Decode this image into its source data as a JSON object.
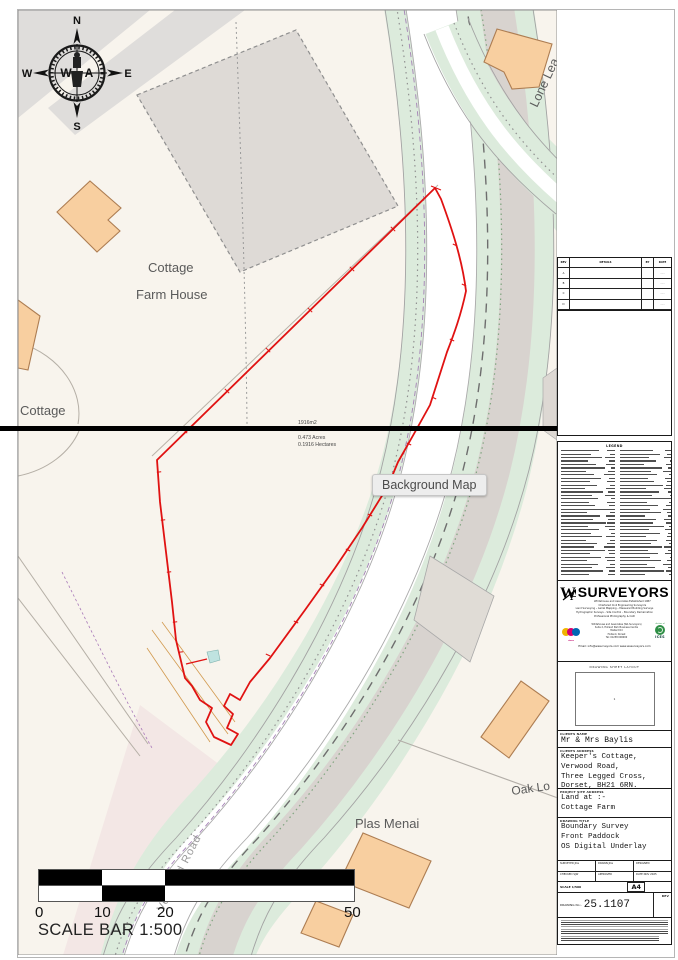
{
  "map": {
    "tooltip": "Background Map",
    "labels": {
      "cottage_top": "Cottage",
      "farm_house": "Farm House",
      "cottage_left": "Cottage",
      "lone_lea": "Lone Lea",
      "plas_menai": "Plas Menai",
      "oak_lodge": "Oak Lo",
      "verwood_road": "Verwood Road"
    },
    "area": {
      "sqm": "1916m2",
      "acres": "0.473 Acres",
      "hectares": "0.1916 Hectares"
    },
    "compass": {
      "n": "N",
      "s": "S",
      "e": "E",
      "w": "W",
      "inner_w": "W",
      "inner_a": "A"
    },
    "scale_bar": {
      "ticks": [
        "0",
        "10",
        "20",
        "50"
      ],
      "caption": "SCALE BAR 1:500"
    }
  },
  "panel": {
    "revisions": {
      "headers": [
        "REV",
        "DETAILS",
        "BY",
        "DATE"
      ],
      "rows": [
        [
          "A",
          "",
          "",
          "··.··"
        ],
        [
          "B",
          "",
          "",
          "··.··"
        ],
        [
          "C",
          "",
          "",
          "··.··"
        ],
        [
          "D",
          "",
          "",
          "··.··"
        ]
      ]
    },
    "legend_title": "LEGEND",
    "firm": {
      "monogram": "W&A",
      "name": "SURVEYORS",
      "sub1": "Whitehouse and Associates      Established 1987",
      "sub2": "Chartered Civil Engineering Surveyors",
      "services": [
        "Land Surveying – Aerial Mapping – Measured Building Surveys",
        "Hydrographic Surveys – Site Control – Boundary Demarcation",
        "Professional Photography & CAD"
      ],
      "contact_lines": [
        "Whitehouse and Associates (WA Surveyors)",
        "Suite 2, Holland Park Business Centre",
        "Mallard Rd",
        "Holland, Dorset",
        "Tel: 01258 000000"
      ],
      "email_line": "Email: info@wasurveyors.com    www.wasurveyors.com",
      "cices_caption": "cices",
      "ices_caption": "division of",
      "ices_name": "ICES"
    },
    "sheet_layout": {
      "title": "DRAWING SHEET LAYOUT",
      "page_num": "1"
    },
    "client": {
      "label": "CLIENTS NAME",
      "name": "Mr & Mrs Baylis"
    },
    "address": {
      "label": "CLIENTS ADDRESS",
      "lines": [
        "Keeper's Cottage,",
        "Verwood Road,",
        "Three Legged Cross,",
        "Dorset, BH21 6RN."
      ]
    },
    "site": {
      "label": "PROJECT SITE ADDRESS",
      "lines": [
        "Land at :-",
        "Cottage Farm"
      ]
    },
    "drawing_title": {
      "label": "DRAWING TITLE",
      "lines": [
        "Boundary Survey",
        "Front Paddock",
        "OS Digital Underlay"
      ]
    },
    "credits": {
      "rows": [
        [
          "SURVEYED  JDa",
          "DRAWN  JDa",
          "DESIGNED"
        ],
        [
          "CHECKED  SJW",
          "APPROVED",
          "DATE  NOV 2025"
        ]
      ]
    },
    "scale": {
      "label": "SCALE 1/500",
      "paper": "A4"
    },
    "drawing_no": {
      "label": "DRAWING No:-",
      "value": "25.1107",
      "rev_label": "REV"
    }
  },
  "colors": {
    "boundary_red": "#e01212",
    "map_cream": "#f8f4ed",
    "verge_green": "#dcebdc",
    "building_orange": "#f8cfa0",
    "building_gray": "#dedad6",
    "purple_boundary": "#a481b5"
  }
}
